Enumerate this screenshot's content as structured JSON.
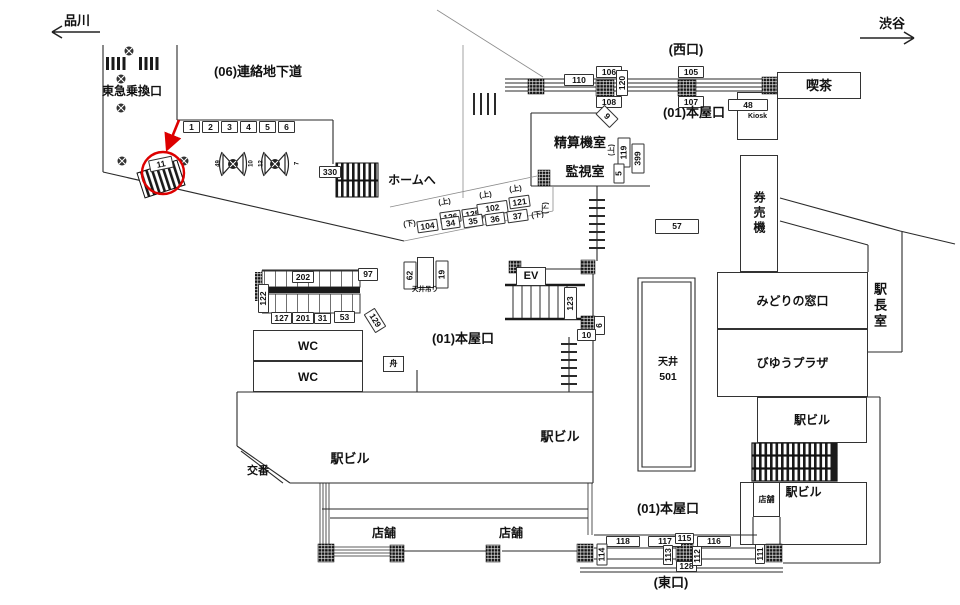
{
  "title": "station-concourse-floor-plan",
  "colors": {
    "line": "#2a2a2a",
    "light_line": "#8c8c8c",
    "dark_fill": "#1a1a1a",
    "highlight_red": "#dd0000",
    "background": "#ffffff"
  },
  "highlight": {
    "target_sign": "11",
    "color": "#dd0000"
  },
  "nav": {
    "left": "品川",
    "right": "渋谷"
  },
  "map_labels": [
    {
      "name": "kissa-room",
      "cls": "room bg",
      "text": "喫茶",
      "x": 777,
      "y": 72,
      "w": 84,
      "h": 27,
      "fs": 13
    },
    {
      "name": "kiosk-room",
      "cls": "room",
      "text": "Kiosk",
      "x": 737,
      "y": 92,
      "w": 41,
      "h": 48,
      "fs": 7
    },
    {
      "name": "kenbaiki-room",
      "cls": "room vtext",
      "text": "券売機",
      "x": 740,
      "y": 155,
      "w": 38,
      "h": 117,
      "fs": 12
    },
    {
      "name": "midori-room",
      "cls": "room",
      "text": "みどりの窓口",
      "x": 717,
      "y": 272,
      "w": 151,
      "h": 57,
      "fs": 12
    },
    {
      "name": "viewplaza-room",
      "cls": "room",
      "text": "びゆうプラザ",
      "x": 717,
      "y": 329,
      "w": 151,
      "h": 68,
      "fs": 12
    },
    {
      "name": "wc-room-1",
      "cls": "room",
      "text": "WC",
      "x": 253,
      "y": 330,
      "w": 110,
      "h": 31,
      "fs": 12
    },
    {
      "name": "wc-room-2",
      "cls": "room",
      "text": "WC",
      "x": 253,
      "y": 361,
      "w": 110,
      "h": 31,
      "fs": 12
    },
    {
      "name": "ev-room",
      "cls": "room bg",
      "text": "EV",
      "x": 516,
      "y": 267,
      "w": 30,
      "h": 19,
      "fs": 11
    },
    {
      "name": "funa-room",
      "cls": "room",
      "text": "舟",
      "x": 383,
      "y": 356,
      "w": 21,
      "h": 16,
      "fs": 8
    },
    {
      "name": "ceiling-hanger-box",
      "cls": "room",
      "text": "",
      "x": 417,
      "y": 257,
      "w": 17,
      "h": 31
    },
    {
      "name": "ekibiru-upper-right-room",
      "cls": "room",
      "text": "駅ビル",
      "x": 757,
      "y": 397,
      "w": 110,
      "h": 46,
      "fs": 12
    },
    {
      "name": "ekibiru-lower-right-room",
      "cls": "room va-top",
      "text": "駅ビル",
      "x": 740,
      "y": 482,
      "w": 127,
      "h": 63,
      "fs": 12
    },
    {
      "name": "tenpo-room-right",
      "cls": "room",
      "text": "店舗",
      "x": 753,
      "y": 482,
      "w": 27,
      "h": 35,
      "fs": 8
    },
    {
      "name": "sign-1",
      "cls": "plate",
      "text": "1",
      "x": 183,
      "y": 121,
      "w": 17,
      "h": 12
    },
    {
      "name": "sign-2",
      "cls": "plate",
      "text": "2",
      "x": 202,
      "y": 121,
      "w": 17,
      "h": 12
    },
    {
      "name": "sign-3",
      "cls": "plate",
      "text": "3",
      "x": 221,
      "y": 121,
      "w": 17,
      "h": 12
    },
    {
      "name": "sign-4",
      "cls": "plate",
      "text": "4",
      "x": 240,
      "y": 121,
      "w": 17,
      "h": 12
    },
    {
      "name": "sign-5-row",
      "cls": "plate",
      "text": "5",
      "x": 259,
      "y": 121,
      "w": 17,
      "h": 12
    },
    {
      "name": "sign-6-row",
      "cls": "plate",
      "text": "6",
      "x": 278,
      "y": 121,
      "w": 17,
      "h": 12
    },
    {
      "name": "sign-330",
      "cls": "plate",
      "text": "330",
      "x": 319,
      "y": 166,
      "w": 22,
      "h": 12
    },
    {
      "name": "sign-11-highlighted",
      "cls": "plate",
      "text": "11",
      "x": 149,
      "y": 158,
      "w": 24,
      "h": 12,
      "tilt": -12
    },
    {
      "name": "sign-110",
      "cls": "plate",
      "text": "110",
      "x": 564,
      "y": 74,
      "w": 30,
      "h": 12
    },
    {
      "name": "sign-106",
      "cls": "plate",
      "text": "106",
      "x": 596,
      "y": 66,
      "w": 26,
      "h": 12
    },
    {
      "name": "sign-108",
      "cls": "plate",
      "text": "108",
      "x": 596,
      "y": 96,
      "w": 26,
      "h": 12
    },
    {
      "name": "sign-120",
      "cls": "plate",
      "text": "120",
      "x": 616,
      "y": 70,
      "w": 12,
      "h": 26,
      "rot": 1
    },
    {
      "name": "sign-105",
      "cls": "plate",
      "text": "105",
      "x": 678,
      "y": 66,
      "w": 26,
      "h": 12
    },
    {
      "name": "sign-107",
      "cls": "plate",
      "text": "107",
      "x": 678,
      "y": 96,
      "w": 26,
      "h": 12
    },
    {
      "name": "sign-48",
      "cls": "plate",
      "text": "48",
      "x": 728,
      "y": 99,
      "w": 40,
      "h": 12
    },
    {
      "name": "sign-9",
      "cls": "plate",
      "text": "9",
      "x": 597,
      "y": 110,
      "w": 20,
      "h": 13,
      "tilt": 45
    },
    {
      "name": "sign-119",
      "cls": "plate",
      "text": "119",
      "x": 617,
      "y": 137,
      "w": 13,
      "h": 30,
      "rot": 1
    },
    {
      "name": "sign-399",
      "cls": "plate",
      "text": "399",
      "x": 631,
      "y": 143,
      "w": 13,
      "h": 30,
      "rot": 1
    },
    {
      "name": "sign-5",
      "cls": "plate",
      "text": "5",
      "x": 613,
      "y": 163,
      "w": 11,
      "h": 20,
      "rot": 1
    },
    {
      "name": "sign-57",
      "cls": "plate",
      "text": "57",
      "x": 655,
      "y": 219,
      "w": 44,
      "h": 15
    },
    {
      "name": "sign-126",
      "cls": "plate",
      "text": "126",
      "x": 440,
      "y": 211,
      "w": 21,
      "h": 12,
      "tilt": -8
    },
    {
      "name": "sign-125",
      "cls": "plate",
      "text": "125",
      "x": 462,
      "y": 208,
      "w": 21,
      "h": 12,
      "tilt": -8
    },
    {
      "name": "sign-102",
      "cls": "plate",
      "text": "102",
      "x": 477,
      "y": 202,
      "w": 31,
      "h": 13,
      "tilt": -8
    },
    {
      "name": "sign-121",
      "cls": "plate",
      "text": "121",
      "x": 509,
      "y": 196,
      "w": 21,
      "h": 12,
      "tilt": -8
    },
    {
      "name": "sign-104",
      "cls": "plate",
      "text": "104",
      "x": 417,
      "y": 220,
      "w": 21,
      "h": 12,
      "tilt": -8
    },
    {
      "name": "sign-34",
      "cls": "plate",
      "text": "34",
      "x": 441,
      "y": 217,
      "w": 19,
      "h": 12,
      "tilt": -8
    },
    {
      "name": "sign-35",
      "cls": "plate",
      "text": "35",
      "x": 463,
      "y": 215,
      "w": 20,
      "h": 12,
      "tilt": -8
    },
    {
      "name": "sign-36",
      "cls": "plate",
      "text": "36",
      "x": 485,
      "y": 213,
      "w": 20,
      "h": 12,
      "tilt": -8
    },
    {
      "name": "sign-37",
      "cls": "plate",
      "text": "37",
      "x": 507,
      "y": 210,
      "w": 21,
      "h": 12,
      "tilt": -8
    },
    {
      "name": "sign-202",
      "cls": "plate",
      "text": "202",
      "x": 292,
      "y": 271,
      "w": 22,
      "h": 12
    },
    {
      "name": "sign-97",
      "cls": "plate",
      "text": "97",
      "x": 358,
      "y": 268,
      "w": 20,
      "h": 13
    },
    {
      "name": "sign-122",
      "cls": "plate",
      "text": "122",
      "x": 258,
      "y": 284,
      "w": 11,
      "h": 29,
      "rot": 1
    },
    {
      "name": "sign-127",
      "cls": "plate",
      "text": "127",
      "x": 271,
      "y": 312,
      "w": 21,
      "h": 12
    },
    {
      "name": "sign-201",
      "cls": "plate",
      "text": "201",
      "x": 292,
      "y": 312,
      "w": 22,
      "h": 12
    },
    {
      "name": "sign-31",
      "cls": "plate",
      "text": "31",
      "x": 314,
      "y": 313,
      "w": 17,
      "h": 11
    },
    {
      "name": "sign-53",
      "cls": "plate",
      "text": "53",
      "x": 334,
      "y": 311,
      "w": 21,
      "h": 12
    },
    {
      "name": "sign-129",
      "cls": "plate",
      "text": "129",
      "x": 364,
      "y": 314,
      "w": 22,
      "h": 13,
      "tilt": 58
    },
    {
      "name": "sign-62",
      "cls": "plate",
      "text": "62",
      "x": 403,
      "y": 261,
      "w": 13,
      "h": 28,
      "rot": 1
    },
    {
      "name": "sign-19",
      "cls": "plate",
      "text": "19",
      "x": 435,
      "y": 260,
      "w": 13,
      "h": 28,
      "rot": 1
    },
    {
      "name": "sign-123",
      "cls": "plate",
      "text": "123",
      "x": 564,
      "y": 287,
      "w": 13,
      "h": 33,
      "rot": 1
    },
    {
      "name": "sign-6",
      "cls": "plate",
      "text": "6",
      "x": 594,
      "y": 316,
      "w": 11,
      "h": 19,
      "rot": 1
    },
    {
      "name": "sign-10",
      "cls": "plate",
      "text": "10",
      "x": 577,
      "y": 329,
      "w": 19,
      "h": 12
    },
    {
      "name": "sign-118",
      "cls": "plate",
      "text": "118",
      "x": 606,
      "y": 536,
      "w": 34,
      "h": 11
    },
    {
      "name": "sign-117",
      "cls": "plate",
      "text": "117",
      "x": 648,
      "y": 536,
      "w": 34,
      "h": 11
    },
    {
      "name": "sign-115",
      "cls": "plate",
      "text": "115",
      "x": 675,
      "y": 533,
      "w": 19,
      "h": 11
    },
    {
      "name": "sign-116",
      "cls": "plate",
      "text": "116",
      "x": 697,
      "y": 536,
      "w": 34,
      "h": 11
    },
    {
      "name": "sign-128",
      "cls": "plate",
      "text": "128",
      "x": 676,
      "y": 561,
      "w": 21,
      "h": 11
    },
    {
      "name": "sign-114",
      "cls": "plate",
      "text": "114",
      "x": 596,
      "y": 543,
      "w": 11,
      "h": 22,
      "rot": 1
    },
    {
      "name": "sign-113",
      "cls": "plate",
      "text": "113",
      "x": 663,
      "y": 545,
      "w": 10,
      "h": 20,
      "rot": 1
    },
    {
      "name": "sign-112",
      "cls": "plate",
      "text": "112",
      "x": 692,
      "y": 546,
      "w": 10,
      "h": 20,
      "rot": 1
    },
    {
      "name": "sign-111",
      "cls": "plate",
      "text": "111",
      "x": 755,
      "y": 544,
      "w": 10,
      "h": 20,
      "rot": 1
    },
    {
      "name": "nav-shinagawa",
      "cls": "t",
      "text": "品川",
      "x": 57,
      "y": 12,
      "w": 40,
      "h": 16,
      "fs": 13
    },
    {
      "name": "nav-shibuya",
      "cls": "t",
      "text": "渋谷",
      "x": 872,
      "y": 15,
      "w": 40,
      "h": 16,
      "fs": 13
    },
    {
      "name": "area-tokyu-transfer",
      "cls": "t",
      "text": "東急乗換口",
      "x": 93,
      "y": 84,
      "w": 78,
      "h": 13,
      "fs": 12
    },
    {
      "name": "area-renraku-chikado",
      "cls": "t",
      "text": "(06)連絡地下道",
      "x": 199,
      "y": 63,
      "w": 118,
      "h": 16,
      "fs": 13
    },
    {
      "name": "area-nishiguchi",
      "cls": "t",
      "text": "(西口)",
      "x": 660,
      "y": 41,
      "w": 52,
      "h": 16,
      "fs": 13
    },
    {
      "name": "area-honya-top",
      "cls": "t",
      "text": "(01)本屋口",
      "x": 653,
      "y": 104,
      "w": 82,
      "h": 16,
      "fs": 13
    },
    {
      "name": "room-seisanki",
      "cls": "t",
      "text": "精算機室",
      "x": 538,
      "y": 135,
      "w": 84,
      "h": 15,
      "fs": 13
    },
    {
      "name": "room-kanshi",
      "cls": "t",
      "text": "監視室",
      "x": 551,
      "y": 164,
      "w": 68,
      "h": 15,
      "fs": 13
    },
    {
      "name": "label-home-e",
      "cls": "t",
      "text": "ホームへ",
      "x": 381,
      "y": 173,
      "w": 62,
      "h": 14,
      "fs": 12
    },
    {
      "name": "dir-shita-ladder",
      "cls": "t dir",
      "text": "(下)",
      "x": 540,
      "y": 199,
      "w": 10,
      "h": 17,
      "rot": 1,
      "fs": 7
    },
    {
      "name": "dir-ue-119",
      "cls": "t dir",
      "text": "(上)",
      "x": 606,
      "y": 141,
      "w": 10,
      "h": 17,
      "rot": 1,
      "fs": 7
    },
    {
      "name": "dir-ue-1",
      "cls": "t dir",
      "text": "(上)",
      "x": 436,
      "y": 197,
      "w": 17,
      "h": 9,
      "tilt": -8,
      "fs": 7.5
    },
    {
      "name": "dir-ue-2",
      "cls": "t dir",
      "text": "(上)",
      "x": 477,
      "y": 190,
      "w": 17,
      "h": 9,
      "tilt": -8,
      "fs": 7.5
    },
    {
      "name": "dir-ue-3",
      "cls": "t dir",
      "text": "(上)",
      "x": 507,
      "y": 184,
      "w": 17,
      "h": 9,
      "tilt": -8,
      "fs": 7.5
    },
    {
      "name": "dir-shita-1",
      "cls": "t dir",
      "text": "(下)",
      "x": 401,
      "y": 219,
      "w": 17,
      "h": 9,
      "tilt": -8,
      "fs": 7.5
    },
    {
      "name": "dir-shita-2",
      "cls": "t dir",
      "text": "(下)",
      "x": 529,
      "y": 210,
      "w": 17,
      "h": 9,
      "tilt": -8,
      "fs": 7.5
    },
    {
      "name": "room-ekicho",
      "cls": "t vtext",
      "text": "駅長室",
      "x": 871,
      "y": 281,
      "w": 17,
      "h": 50,
      "fs": 13
    },
    {
      "name": "label-tenjo",
      "cls": "t",
      "text": "天井",
      "x": 654,
      "y": 357,
      "w": 28,
      "h": 12,
      "fs": 10
    },
    {
      "name": "label-tenjo-501",
      "cls": "t",
      "text": "501",
      "x": 654,
      "y": 371,
      "w": 28,
      "h": 12,
      "fs": 10.5
    },
    {
      "name": "label-tenjo-tsuri",
      "cls": "t",
      "text": "天井吊り",
      "x": 402,
      "y": 286,
      "w": 46,
      "h": 8,
      "fs": 6.5
    },
    {
      "name": "area-honya-mid",
      "cls": "t",
      "text": "(01)本屋口",
      "x": 422,
      "y": 330,
      "w": 82,
      "h": 16,
      "fs": 13
    },
    {
      "name": "area-honya-bottom",
      "cls": "t",
      "text": "(01)本屋口",
      "x": 627,
      "y": 500,
      "w": 82,
      "h": 16,
      "fs": 13
    },
    {
      "name": "area-higashiguchi",
      "cls": "t",
      "text": "(東口)",
      "x": 643,
      "y": 574,
      "w": 56,
      "h": 16,
      "fs": 13
    },
    {
      "name": "label-ekibiru-main",
      "cls": "t",
      "text": "駅ビル",
      "x": 328,
      "y": 451,
      "w": 44,
      "h": 15,
      "fs": 13
    },
    {
      "name": "label-ekibiru-2",
      "cls": "t",
      "text": "駅ビル",
      "x": 538,
      "y": 429,
      "w": 44,
      "h": 15,
      "fs": 13
    },
    {
      "name": "label-koban",
      "cls": "t",
      "text": "交番",
      "x": 241,
      "y": 465,
      "w": 34,
      "h": 13,
      "fs": 11
    },
    {
      "name": "label-tenpo-1",
      "cls": "t",
      "text": "店舗",
      "x": 367,
      "y": 526,
      "w": 34,
      "h": 13,
      "fs": 12
    },
    {
      "name": "label-tenpo-2",
      "cls": "t",
      "text": "店舗",
      "x": 494,
      "y": 526,
      "w": 34,
      "h": 13,
      "fs": 12
    },
    {
      "name": "gate-num-49",
      "cls": "t",
      "text": "49",
      "x": 214,
      "y": 158,
      "w": 7,
      "h": 10,
      "rot": 1,
      "fs": 6
    },
    {
      "name": "gate-num-10",
      "cls": "t",
      "text": "10",
      "x": 247,
      "y": 158,
      "w": 7,
      "h": 10,
      "rot": 1,
      "fs": 6
    },
    {
      "name": "gate-num-12",
      "cls": "t",
      "text": "12",
      "x": 257,
      "y": 158,
      "w": 7,
      "h": 10,
      "rot": 1,
      "fs": 6
    },
    {
      "name": "gate-num-7",
      "cls": "t",
      "text": "7",
      "x": 293,
      "y": 158,
      "w": 7,
      "h": 10,
      "rot": 1,
      "fs": 6
    }
  ]
}
